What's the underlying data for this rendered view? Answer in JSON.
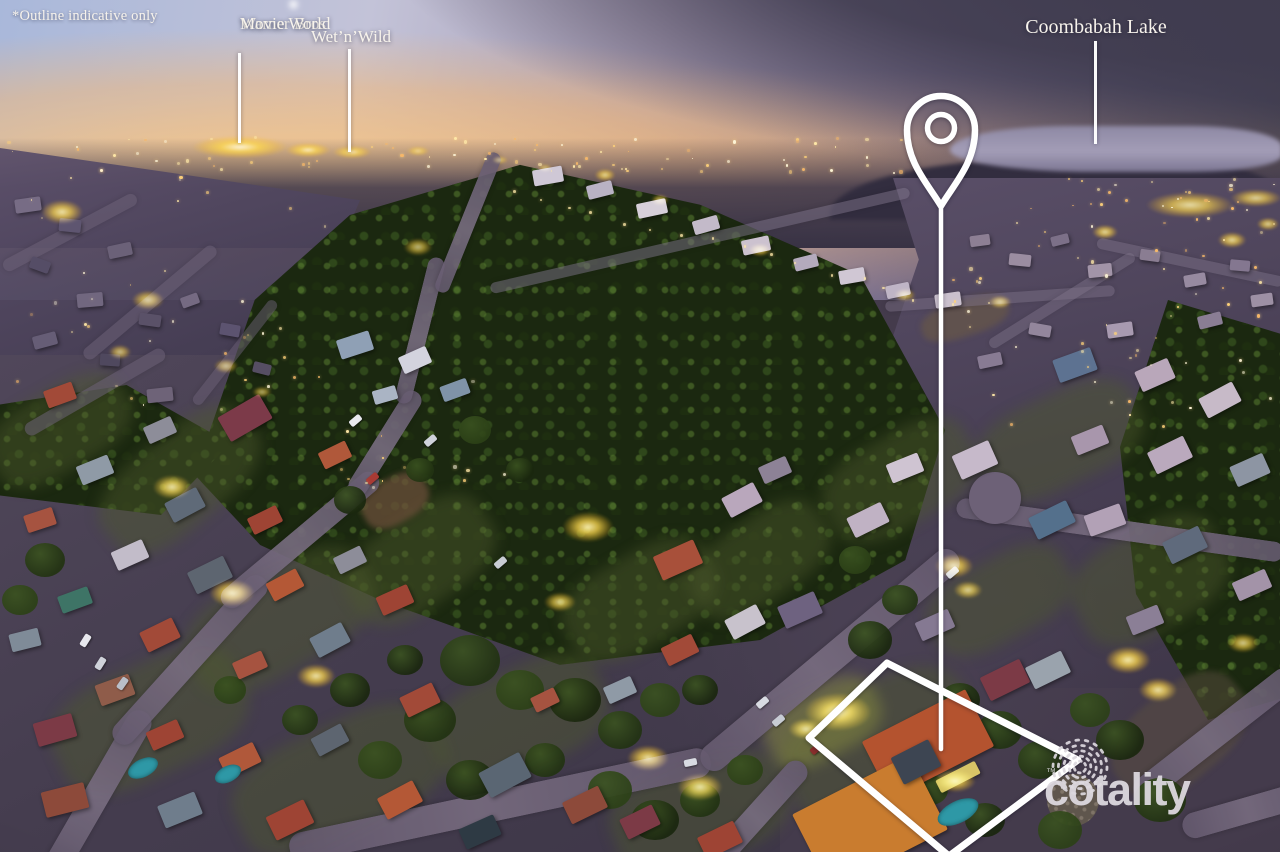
{
  "annotations": {
    "disclaimer": "*Outline indicative only",
    "movie_world": {
      "line1": "Warner Bros",
      "line2": "Movie World"
    },
    "wet_n_wild": {
      "text": "Wet’n’Wild"
    },
    "coombabah": {
      "text": "Coombabah Lake"
    }
  },
  "branding": {
    "logo_text": "cotality",
    "trademark": "™"
  },
  "colors": {
    "annotation_text": "#f7f3ec",
    "marker_white": "#ffffff",
    "logo_gray": "#dcd8de",
    "streetlight_glow": "#ffd84a",
    "streetlight_core": "#fff3b0",
    "sky_peach": "#e9b98d",
    "sky_blue": "#a9b8da",
    "cloud_purple": "#4a4658",
    "forest_green": "#1b2810",
    "roof_terracotta": "#b4532f",
    "road_purple": "#655a6f",
    "pool_teal": "#2e98a6"
  }
}
